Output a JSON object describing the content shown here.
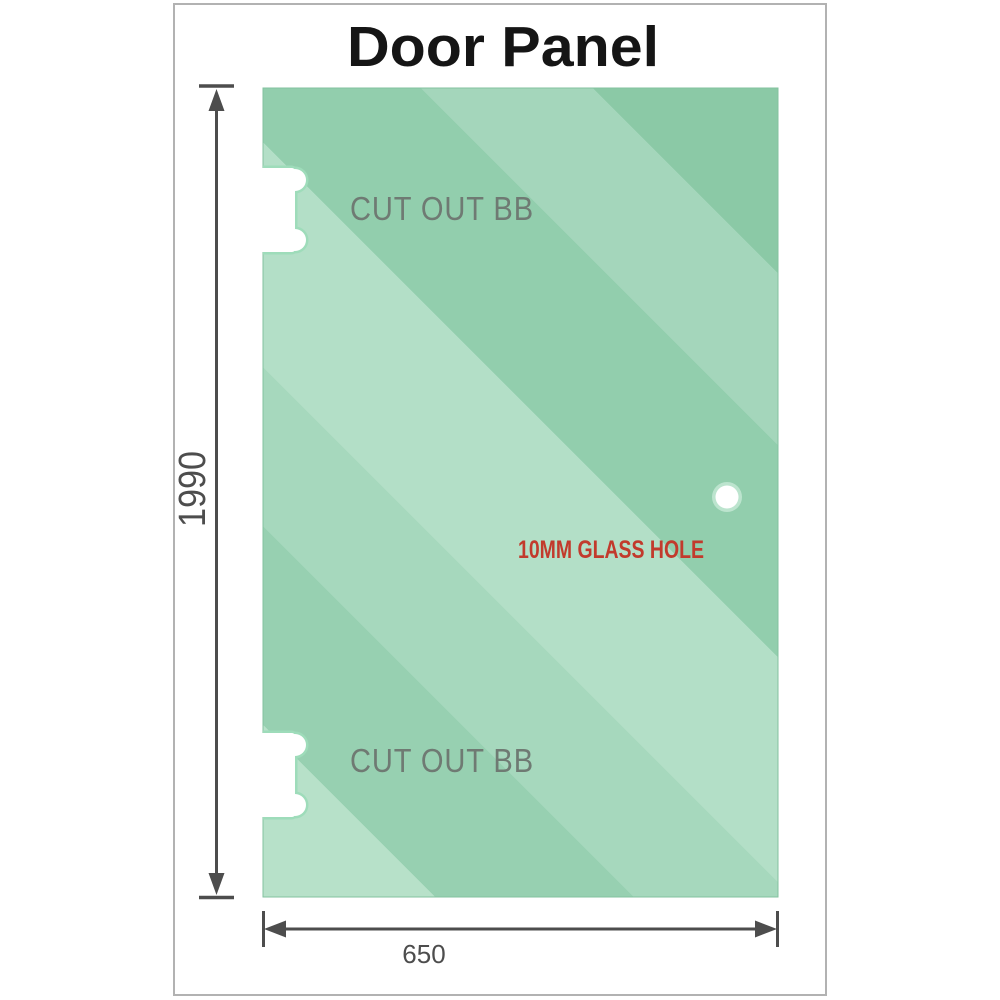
{
  "title": "Door Panel",
  "glass_panel": {
    "cutouts": [
      {
        "label": "CUT OUT BB"
      },
      {
        "label": "CUT OUT BB"
      }
    ],
    "hole": {
      "label": "10MM GLASS HOLE"
    }
  },
  "dimensions": {
    "height": "1990",
    "width": "650"
  },
  "colors": {
    "title_text": "#151515",
    "frame_border": "#b2b2b2",
    "glass_edge": "#83c29f",
    "glass_bands": [
      "#b7e1c9",
      "#97d0b1",
      "#a6d8bd",
      "#b3dfc7",
      "#92cead",
      "#a4d6bb",
      "#8bc9a6"
    ],
    "cutout_outline": "#9edcba",
    "cutout_fill": "#ffffff",
    "cutout_label": "#6f7a73",
    "hole_ring": "#bce4ce",
    "hole_fill": "#ffffff",
    "hole_label": "#c23a2c",
    "dimension": "#4d4d4d"
  }
}
